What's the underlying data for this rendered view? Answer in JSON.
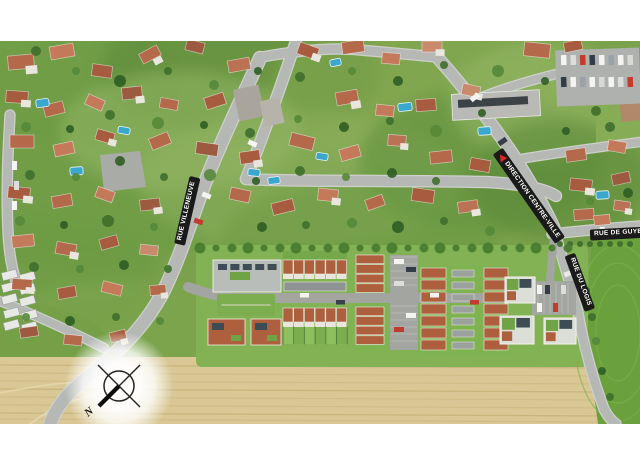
{
  "map": {
    "street_labels": [
      {
        "id": "rue-villeneuve",
        "text": "RUE VILLENEUVE"
      },
      {
        "id": "direction-centre-ville",
        "text": "DIRECTION CENTRE-VILLE"
      },
      {
        "id": "rue-de-guyenne",
        "text": "RUE DE GUYENNE"
      },
      {
        "id": "rue-du-logis",
        "text": "RUE DU LOGIS"
      }
    ],
    "compass": {
      "north_label": "N"
    }
  },
  "colors": {
    "label_banner_bg": "#1a1a1a",
    "label_text": "#ffffff",
    "direction_arrow_red": "#d6281e",
    "road_gray": "#b5b8b4",
    "vegetation_green": "#7aa24c",
    "field_tan": "#d9c895",
    "crop_field_green": "#6ba13c",
    "roof_terracotta": "#ad5f3e",
    "pool_blue": "#3aa7cd"
  }
}
